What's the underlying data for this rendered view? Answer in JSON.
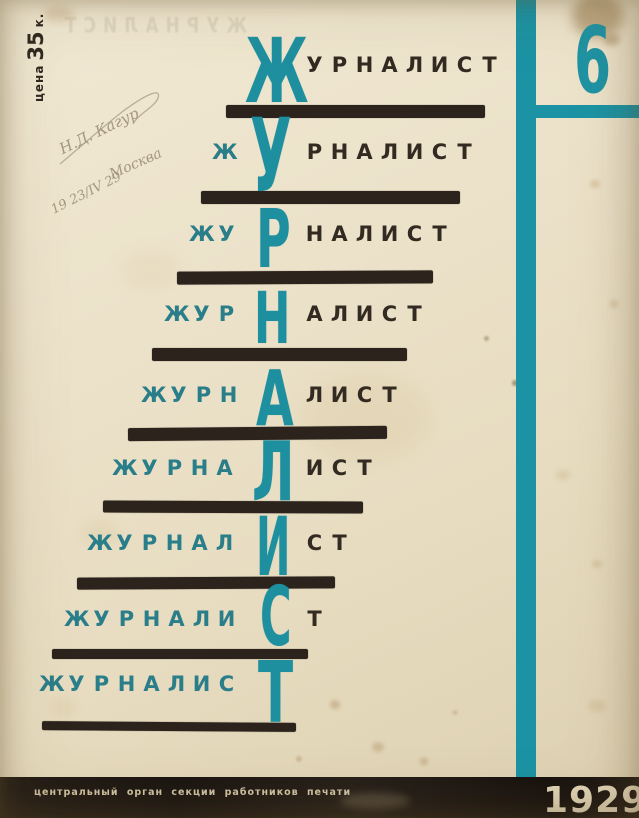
{
  "colors": {
    "teal_accent": "#1e90a1",
    "teal_muted": "#2a7e89",
    "ink_black": "#2b231c",
    "footer_black": "#1d1814",
    "footer_text_cream": "#d6c9a8",
    "year_cream": "#e4d8ba",
    "paper_cream": "#eae0c8"
  },
  "price": {
    "prefix": "цена",
    "amount": "35",
    "suffix": "к."
  },
  "issue": {
    "number": "6"
  },
  "ghost": {
    "text": "ЖУРНАЛИСТ"
  },
  "handwriting": {
    "signature": "Н.Д. Кагур",
    "date": "19 23/IV 29",
    "place": "Москва"
  },
  "footer": {
    "text": "центральный орган секции работников печати",
    "year": "1929"
  },
  "masthead": {
    "word": "ЖУРНАЛИСТ",
    "suffix_left": 302,
    "cell_w": 25,
    "letter_advance_em": {
      "Ж": 1.1,
      "У": 0.74,
      "Р": 0.76,
      "Н": 0.85,
      "А": 0.78,
      "Л": 0.8,
      "И": 0.85,
      "С": 0.79,
      "Т": 0.68
    },
    "rows": [
      {
        "prefix": "",
        "big": "Ж",
        "suffix": "УРНАЛИСТ",
        "prefix_left": 242,
        "text_top": 57,
        "big_x": 245,
        "big_top": 38,
        "big_h": 65,
        "big_w": 57,
        "bar": {
          "x": 226,
          "y": 105,
          "w": 259,
          "h": 13,
          "tilt": 0
        }
      },
      {
        "prefix": "Ж",
        "big": "У",
        "suffix": "РНАЛИСТ",
        "prefix_left": 212,
        "text_top": 144,
        "big_x": 250,
        "big_top": 118,
        "big_h": 74,
        "big_w": 40,
        "bar": {
          "x": 201,
          "y": 191,
          "w": 259,
          "h": 13,
          "tilt": 0
        }
      },
      {
        "prefix": "ЖУ",
        "big": "Р",
        "suffix": "НАЛИСТ",
        "prefix_left": 189,
        "text_top": 226,
        "big_x": 256,
        "big_top": 209,
        "big_h": 59,
        "big_w": 36,
        "bar": {
          "x": 177,
          "y": 271,
          "w": 256,
          "h": 13,
          "tilt": -0.3
        }
      },
      {
        "prefix": "ЖУР",
        "big": "Н",
        "suffix": "АЛИСТ",
        "prefix_left": 164,
        "text_top": 306,
        "big_x": 254,
        "big_top": 291,
        "big_h": 52,
        "big_w": 37,
        "bar": {
          "x": 152,
          "y": 348,
          "w": 255,
          "h": 13,
          "tilt": 0
        }
      },
      {
        "prefix": "ЖУРН",
        "big": "А",
        "suffix": "ЛИСТ",
        "prefix_left": 141,
        "text_top": 387,
        "big_x": 256,
        "big_top": 371,
        "big_h": 56,
        "big_w": 38,
        "bar": {
          "x": 128,
          "y": 427,
          "w": 259,
          "h": 13,
          "tilt": -0.5
        }
      },
      {
        "prefix": "ЖУРНА",
        "big": "Л",
        "suffix": "ИСТ",
        "prefix_left": 112,
        "text_top": 460,
        "big_x": 252,
        "big_top": 442,
        "big_h": 60,
        "big_w": 41,
        "bar": {
          "x": 103,
          "y": 501,
          "w": 260,
          "h": 12,
          "tilt": 0.2
        }
      },
      {
        "prefix": "ЖУРНАЛ",
        "big": "И",
        "suffix": "СТ",
        "prefix_left": 87,
        "text_top": 535,
        "big_x": 256,
        "big_top": 517,
        "big_h": 59,
        "big_w": 35,
        "bar": {
          "x": 77,
          "y": 577,
          "w": 258,
          "h": 12,
          "tilt": -0.3
        }
      },
      {
        "prefix": "ЖУРНАЛИ",
        "big": "С",
        "suffix": "Т",
        "prefix_left": 64,
        "text_top": 611,
        "big_x": 260,
        "big_top": 587,
        "big_h": 60,
        "big_w": 34,
        "bar": {
          "x": 52,
          "y": 649,
          "w": 256,
          "h": 10,
          "tilt": 0
        }
      },
      {
        "prefix": "ЖУРНАЛИС",
        "big": "Т",
        "suffix": "",
        "prefix_left": 39,
        "text_top": 676,
        "big_x": 258,
        "big_top": 661,
        "big_h": 62,
        "big_w": 35,
        "bar": {
          "x": 42,
          "y": 722,
          "w": 254,
          "h": 9,
          "tilt": 0.4
        }
      }
    ]
  }
}
